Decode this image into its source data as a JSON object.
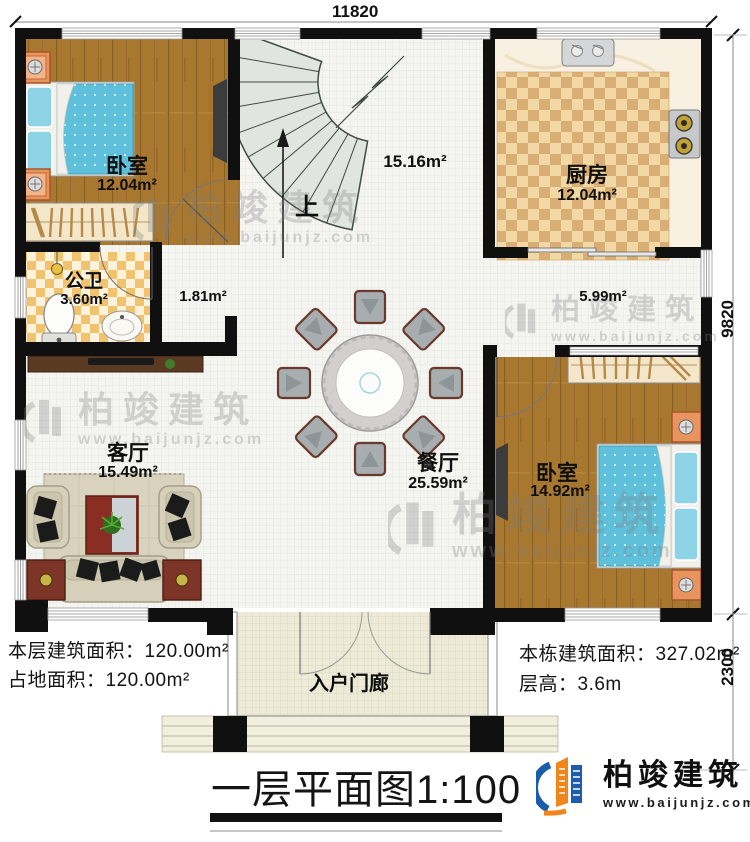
{
  "plan": {
    "title": "一层平面图",
    "scale": "1:100",
    "dims": {
      "top": "11820",
      "side_main": "9820",
      "side_porch": "2300"
    },
    "rooms": {
      "bedroom1": {
        "name": "卧室",
        "area": "12.04m²"
      },
      "kitchen": {
        "name": "厨房",
        "area": "12.04m²"
      },
      "bathroom": {
        "name": "公卫",
        "area": "3.60m²"
      },
      "hallway": {
        "area": "1.81m²"
      },
      "stairhall": {
        "area": "15.16m²"
      },
      "corridor": {
        "area": "5.99m²"
      },
      "living": {
        "name": "客厅",
        "area": "15.49m²"
      },
      "dining": {
        "name": "餐厅",
        "area": "25.59m²"
      },
      "bedroom2": {
        "name": "卧室",
        "area": "14.92m²"
      },
      "porch": {
        "name": "入户门廊"
      }
    },
    "stairs": {
      "up": "上"
    },
    "info_left": [
      {
        "label": "本层建筑面积：",
        "value": "120.00m²"
      },
      {
        "label": "占地面积：",
        "value": "120.00m²"
      }
    ],
    "info_right": [
      {
        "label": "本栋建筑面积：",
        "value": "327.02m²"
      },
      {
        "label": "层高：",
        "value": "3.6m"
      }
    ]
  },
  "branding": {
    "name": "柏竣建筑",
    "url": "www.baijunjz.com"
  },
  "watermark": {
    "name": "柏竣建筑",
    "url": "www.baijunjz.com"
  },
  "colors": {
    "wall": "#101010",
    "wood_floor": "#a87830",
    "bed_blue": "#5fc0dc",
    "stair_fill": "#e0e6df",
    "kitchen_tile": "#d9ae74",
    "bath_tile": "#f2c36e",
    "brand_blue": "#1c5ca8",
    "brand_orange": "#f08519"
  }
}
